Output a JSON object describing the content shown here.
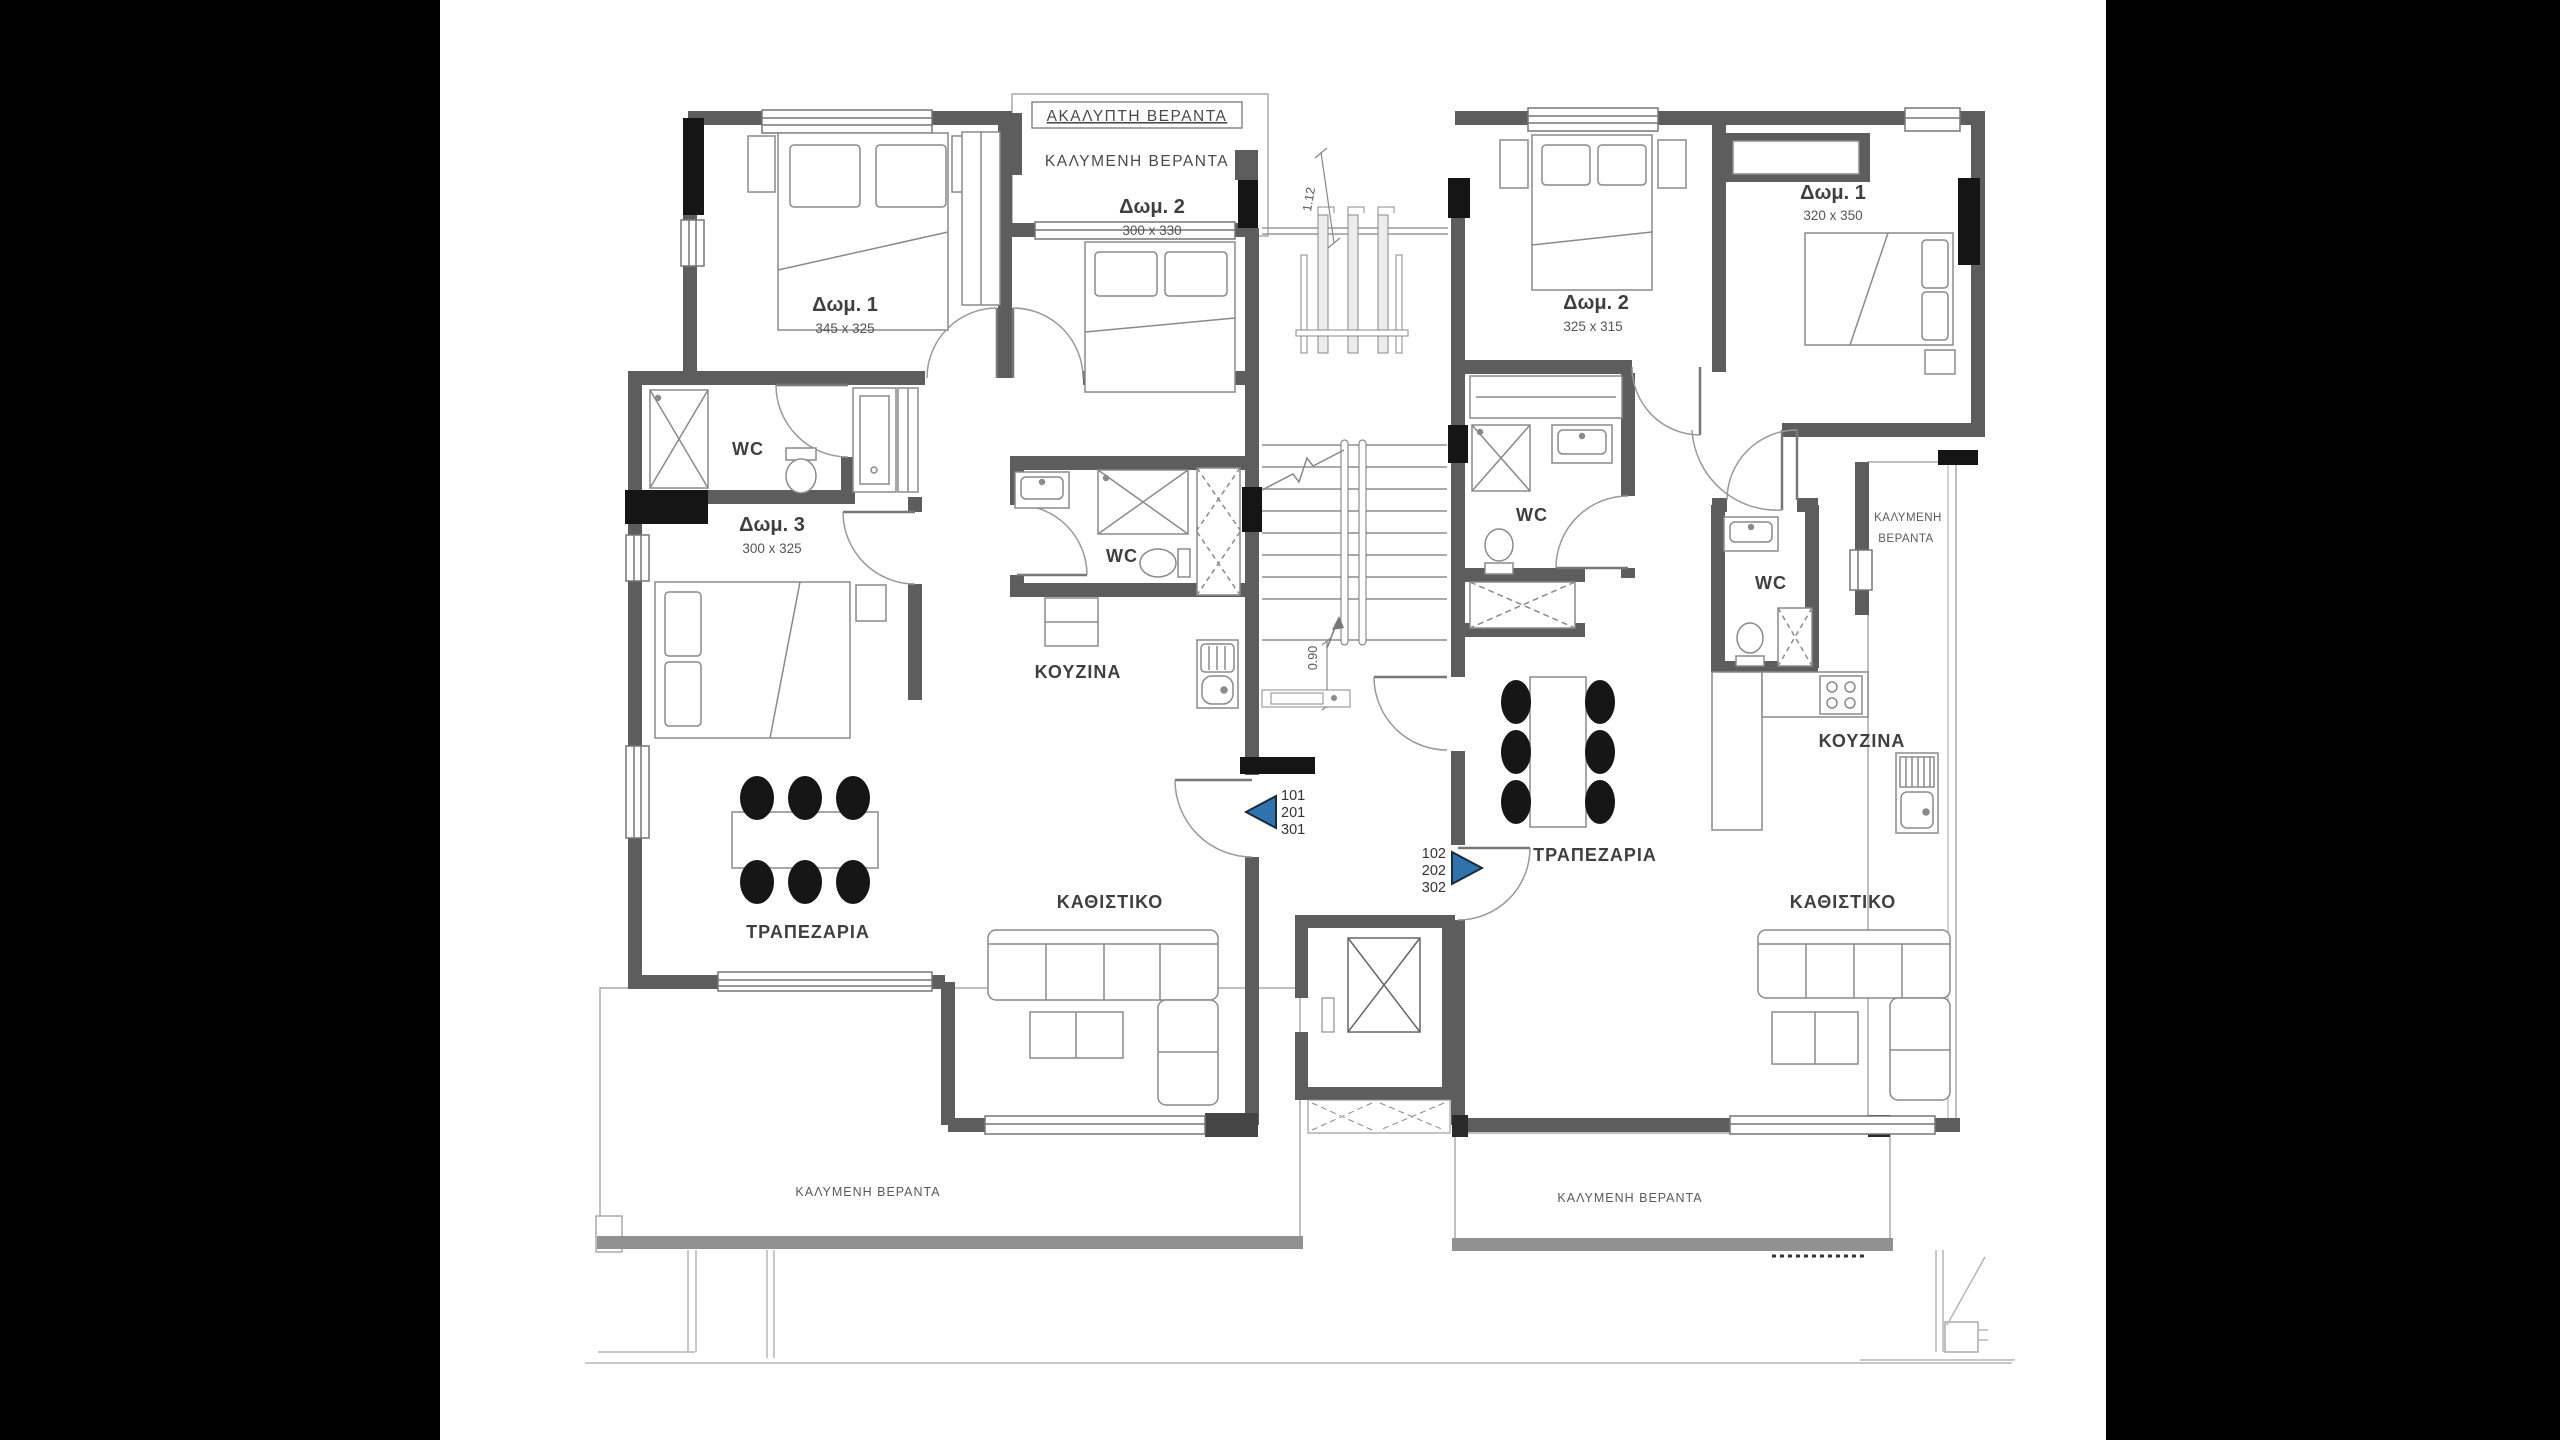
{
  "colors": {
    "wall": "#5d5d5d",
    "column": "#151515",
    "line": "#9b9b9b",
    "furniture": "#8a8a8a",
    "accent_blue": "#2f72ad",
    "text": "#3f3f3f",
    "slab": "#919191"
  },
  "top": {
    "uncovered_veranda": "ΑΚΑΛΥΠΤΗ ΒΕΡΑΝΤΑ",
    "covered_veranda": "ΚΑΛΥΜΕΝΗ ΒΕΡΑΝΤΑ",
    "dim_top": "1.12"
  },
  "core": {
    "stair_dim": "0.90"
  },
  "left_apartment": {
    "bedroom1": {
      "label": "Δωμ. 1",
      "dims": "345 x 325"
    },
    "bedroom2": {
      "label": "Δωμ. 2",
      "dims": "300 x 330"
    },
    "bedroom3": {
      "label": "Δωμ. 3",
      "dims": "300 x 325"
    },
    "wc1": "WC",
    "wc2": "WC",
    "kitchen": "ΚΟΥΖΙΝΑ",
    "dining": "ΤΡΑΠΕΖΑΡΙΑ",
    "living": "ΚΑΘΙΣΤΙΚΟ",
    "veranda": "ΚΑΛΥΜΕΝΗ ΒΕΡΑΝΤΑ",
    "units": [
      "101",
      "201",
      "301"
    ]
  },
  "right_apartment": {
    "bedroom1": {
      "label": "Δωμ. 1",
      "dims": "320 x 350"
    },
    "bedroom2": {
      "label": "Δωμ. 2",
      "dims": "325 x 315"
    },
    "wc1": "WC",
    "wc2": "WC",
    "kitchen": "ΚΟΥΖΙΝΑ",
    "dining": "ΤΡΑΠΕΖΑΡΙΑ",
    "living": "ΚΑΘΙΣΤΙΚΟ",
    "side_veranda_line1": "ΚΑΛΥΜΕΝΗ",
    "side_veranda_line2": "ΒΕΡΑΝΤΑ",
    "veranda": "ΚΑΛΥΜΕΝΗ ΒΕΡΑΝΤΑ",
    "units": [
      "102",
      "202",
      "302"
    ]
  }
}
